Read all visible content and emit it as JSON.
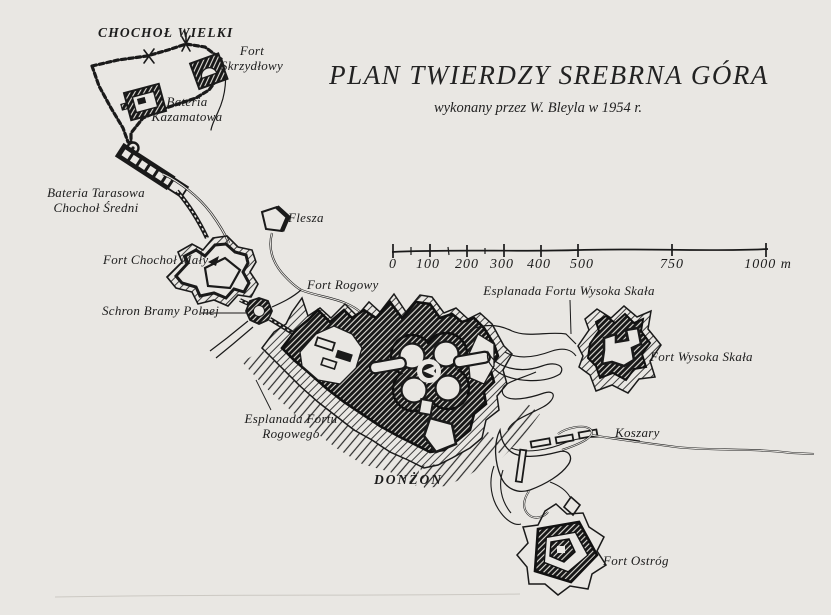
{
  "page": {
    "background_color": "#e9e7e3",
    "ink_color": "#1a1a1a",
    "description": "Scanned hand-drawn plan of the Srebrna Góra fortress"
  },
  "title": {
    "main": "PLAN TWIERDZY SREBRNA GÓRA",
    "subtitle": "wykonany przez W. Bleyla w 1954 r."
  },
  "scale_bar": {
    "unit": "m",
    "ticks": [
      "0",
      "100",
      "200",
      "300",
      "400",
      "500",
      "750",
      "1000 m"
    ]
  },
  "labels": {
    "chochol_wielki": "CHOCHOŁ WIELKI",
    "fort_skrzydlowy_l1": "Fort",
    "fort_skrzydlowy_l2": "Skrzydłowy",
    "bateria_kazamatowa_l1": "Bateria",
    "bateria_kazamatowa_l2": "Kazamatowa",
    "bateria_tarasowa_l1": "Bateria Tarasowa",
    "bateria_tarasowa_l2": "Chochoł Średni",
    "flesza": "Flesza",
    "fort_chochol_maly": "Fort Chochoł Mały",
    "fort_rogowy": "Fort Rogowy",
    "schron_bramy_polnej": "Schron Bramy Polnej",
    "esplanada_wysoka_skala": "Esplanada Fortu Wysoka Skała",
    "fort_wysoka_skala": "Fort Wysoka Skała",
    "esplanada_rogowego_l1": "Esplanada Fortu",
    "esplanada_rogowego_l2": "Rogowego",
    "donzon": "DONŻON",
    "koszary": "Koszary",
    "fort_ostrog": "Fort Ostróg"
  }
}
